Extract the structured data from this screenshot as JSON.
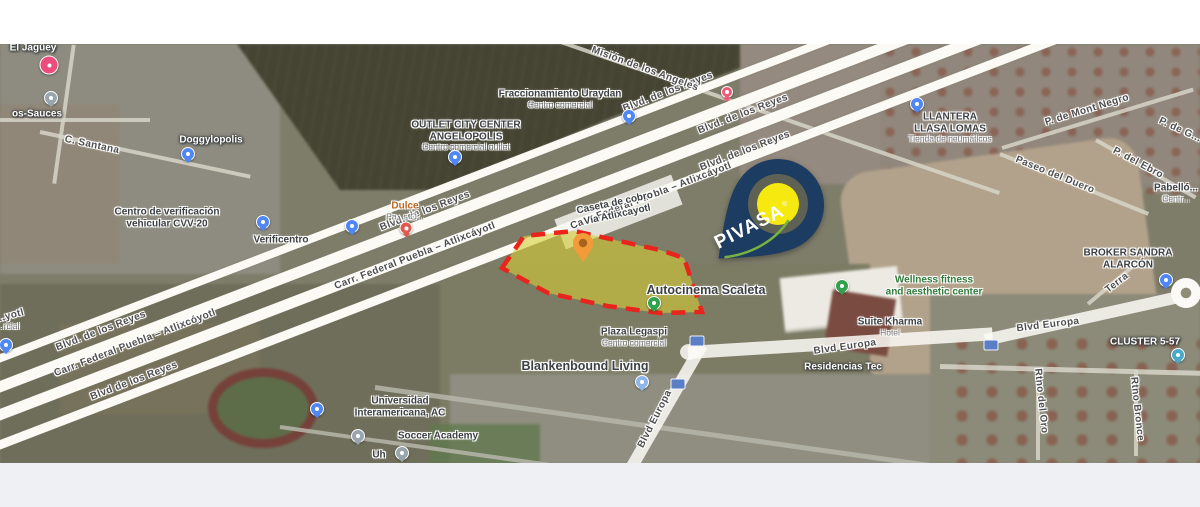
{
  "map_title": "Satellite map – Vía Atlixcáyotl / Blvd Europa, Puebla",
  "parcel": {
    "description": "highlighted lot for sale",
    "fill": "#d6cd34",
    "fill_opacity": 0.6,
    "outline_color": "#e8241d",
    "points": "42,68 64,36 114,31 200,50 224,58 242,112 200,113 147,106 88,93",
    "marker_color": "#f29b38",
    "marker_inner": "#a8641f"
  },
  "brand_pin": {
    "label": "PIVASA",
    "registered": "®",
    "body_color": "#1d3c61",
    "ring_color": "#6f6d52",
    "center_color": "#f6e90f",
    "swoosh_color": "#79b33f",
    "text_color": "#ffffff"
  },
  "road_labels": [
    {
      "t": "Blvd. de los Reyes",
      "x": 668,
      "y": 92,
      "rot": -21
    },
    {
      "t": "Blvd. de los Reyes",
      "x": 743,
      "y": 114,
      "rot": -21
    },
    {
      "t": "Blvd. de los Reyes",
      "x": 745,
      "y": 151,
      "rot": -21
    },
    {
      "t": "Blvd. de los Reyes",
      "x": 425,
      "y": 211,
      "rot": -21
    },
    {
      "t": "Blvd. de los Reyes",
      "x": 101,
      "y": 331,
      "rot": -21
    },
    {
      "t": "Blvd de los Reyes",
      "x": 134,
      "y": 381,
      "rot": -21
    },
    {
      "t": "Carr. Federal Puebla – Atlixcáyotl",
      "x": 651,
      "y": 196,
      "rot": -21
    },
    {
      "t": "Carr. Federal Puebla – Atlixcáyotl",
      "x": 415,
      "y": 256,
      "rot": -21
    },
    {
      "t": "Carr. Federal Puebla – Atlixcóyotl",
      "x": 135,
      "y": 343,
      "rot": -21
    },
    {
      "t": "Blvd Europa",
      "x": 845,
      "y": 347,
      "rot": -8
    },
    {
      "t": "Blvd Europa",
      "x": 1048,
      "y": 325,
      "rot": -7
    },
    {
      "t": "Blvd Europa",
      "x": 655,
      "y": 419,
      "rot": -63
    },
    {
      "t": "Misión de los Angeles",
      "x": 645,
      "y": 69,
      "rot": 20
    },
    {
      "t": "C. Santana",
      "x": 92,
      "y": 145,
      "rot": 12
    },
    {
      "t": "Paseo del Duero",
      "x": 1055,
      "y": 175,
      "rot": 22
    },
    {
      "t": "P. del Ebro",
      "x": 1138,
      "y": 163,
      "rot": 28
    },
    {
      "t": "P. de Mont Negro",
      "x": 1087,
      "y": 110,
      "rot": -17
    },
    {
      "t": "P. de G...",
      "x": 1180,
      "y": 130,
      "rot": 25
    },
    {
      "t": "Terra",
      "x": 1117,
      "y": 283,
      "rot": -38
    },
    {
      "t": "Rtno del Oro",
      "x": 1041,
      "y": 401,
      "rot": 84
    },
    {
      "t": "Rtno Bronce",
      "x": 1137,
      "y": 409,
      "rot": 84
    },
    {
      "t": "...yotl",
      "x": 10,
      "y": 316,
      "rot": -15
    }
  ],
  "place_labels": [
    {
      "x": 33,
      "y": 48,
      "cls": "white",
      "lines": [
        {
          "t": "El Jagüey"
        }
      ]
    },
    {
      "x": 37,
      "y": 114,
      "cls": "white",
      "lines": [
        {
          "t": "os-Sauces"
        }
      ]
    },
    {
      "x": 211,
      "y": 140,
      "cls": "white",
      "lines": [
        {
          "t": "Doggylopolis"
        }
      ]
    },
    {
      "x": 560,
      "y": 99,
      "cls": "bold",
      "lines": [
        {
          "t": "Fraccionamiento Uraydan"
        },
        {
          "t": "Centro comercial",
          "cls": "sub"
        }
      ]
    },
    {
      "x": 466,
      "y": 136,
      "cls": "bold",
      "lines": [
        {
          "t": "OUTLET CITY CENTER"
        },
        {
          "t": "ANGELOPOLIS"
        },
        {
          "t": "Centro comercial outlet",
          "cls": "sub"
        }
      ]
    },
    {
      "x": 167,
      "y": 218,
      "cls": "bold",
      "lines": [
        {
          "t": "Centro de verificación"
        },
        {
          "t": "vehicular CVV-20"
        }
      ]
    },
    {
      "x": 281,
      "y": 240,
      "cls": "bold",
      "lines": [
        {
          "t": "Verificentro"
        }
      ]
    },
    {
      "x": 405,
      "y": 211,
      "cls": "orange",
      "lines": [
        {
          "t": "Dulce"
        },
        {
          "t": "Pa...s O...",
          "cls": "sub"
        }
      ]
    },
    {
      "x": 616,
      "y": 209,
      "rot": -12,
      "cls": "bold",
      "lines": [
        {
          "t": "Caseta de cobro"
        },
        {
          "t": "Vía Atlixcayotl"
        }
      ]
    },
    {
      "x": 950,
      "y": 128,
      "cls": "bold",
      "lines": [
        {
          "t": "LLANTERA"
        },
        {
          "t": "LLASA LOMAS"
        },
        {
          "t": "Tienda de neumáticos",
          "cls": "sub"
        }
      ]
    },
    {
      "x": 706,
      "y": 290,
      "cls": "big",
      "lines": [
        {
          "t": "Autocinema Scaleta"
        }
      ]
    },
    {
      "x": 934,
      "y": 286,
      "cls": "green",
      "lines": [
        {
          "t": "Wellness fitness"
        },
        {
          "t": "and aesthetic center"
        }
      ]
    },
    {
      "x": 890,
      "y": 327,
      "cls": "bold",
      "lines": [
        {
          "t": "Suite Kharma"
        },
        {
          "t": "Hotel",
          "cls": "sub"
        }
      ]
    },
    {
      "x": 634,
      "y": 337,
      "cls": "bold",
      "lines": [
        {
          "t": "Plaza Legaspi"
        },
        {
          "t": "Centro comercial",
          "cls": "sub"
        }
      ]
    },
    {
      "x": 585,
      "y": 366,
      "cls": "big",
      "lines": [
        {
          "t": "Blankenbound Living"
        }
      ]
    },
    {
      "x": 843,
      "y": 367,
      "cls": "white",
      "lines": [
        {
          "t": "Residencias Tec"
        }
      ]
    },
    {
      "x": 400,
      "y": 407,
      "cls": "bold",
      "lines": [
        {
          "t": "Universidad"
        },
        {
          "t": "Interamericana, AC"
        }
      ]
    },
    {
      "x": 438,
      "y": 436,
      "cls": "bold",
      "lines": [
        {
          "t": "Soccer Academy"
        }
      ]
    },
    {
      "x": 1145,
      "y": 342,
      "cls": "white",
      "lines": [
        {
          "t": "CLUSTER 5-57"
        }
      ]
    },
    {
      "x": 1128,
      "y": 259,
      "cls": "bold",
      "lines": [
        {
          "t": "BROKER SANDRA"
        },
        {
          "t": "ALARCÓN"
        }
      ]
    },
    {
      "x": 1176,
      "y": 193,
      "cls": "bold",
      "lines": [
        {
          "t": "Pabelló..."
        },
        {
          "t": "Centr...",
          "cls": "sub"
        }
      ]
    },
    {
      "x": 379,
      "y": 455,
      "cls": "bold",
      "lines": [
        {
          "t": "Uh"
        }
      ]
    },
    {
      "x": 8,
      "y": 327,
      "cls": "bold",
      "lines": [
        {
          "t": "...rcial",
          "cls": "sub"
        }
      ]
    }
  ],
  "pins": [
    {
      "kind": "pinkbig",
      "x": 49,
      "y": 65,
      "name": "heart-pin-el-jaguey"
    },
    {
      "kind": "gray",
      "x": 51,
      "y": 98,
      "name": "gray-pin-los-sauces"
    },
    {
      "kind": "blue",
      "x": 188,
      "y": 154,
      "name": "blue-pin-doggylopolis"
    },
    {
      "kind": "blue",
      "x": 263,
      "y": 222,
      "name": "blue-pin-verificacion"
    },
    {
      "kind": "blue",
      "x": 352,
      "y": 226,
      "name": "blue-pin-verificentro"
    },
    {
      "kind": "food",
      "x": 406,
      "y": 228,
      "name": "red-pin-dulce"
    },
    {
      "kind": "blue",
      "x": 455,
      "y": 157,
      "name": "blue-pin-outlet"
    },
    {
      "kind": "blue",
      "x": 629,
      "y": 116,
      "name": "blue-pin-uraydan"
    },
    {
      "kind": "pinksmall",
      "x": 727,
      "y": 92,
      "name": "pink-pin-reyes"
    },
    {
      "kind": "blue",
      "x": 917,
      "y": 104,
      "name": "blue-pin-llantera"
    },
    {
      "kind": "green",
      "x": 654,
      "y": 303,
      "name": "green-pin-autocinema"
    },
    {
      "kind": "green",
      "x": 842,
      "y": 286,
      "name": "green-pin-wellness"
    },
    {
      "kind": "lightblue",
      "x": 642,
      "y": 382,
      "name": "lightblue-pin-blankenbound"
    },
    {
      "kind": "blue",
      "x": 317,
      "y": 409,
      "name": "blue-pin-universidad"
    },
    {
      "kind": "gray",
      "x": 358,
      "y": 436,
      "name": "gray-pin-soccer-academy"
    },
    {
      "kind": "gray",
      "x": 402,
      "y": 453,
      "name": "gray-pin-uh"
    },
    {
      "kind": "blue",
      "x": 6,
      "y": 345,
      "name": "blue-pin-left-edge"
    },
    {
      "kind": "blue",
      "x": 1166,
      "y": 280,
      "name": "blue-pin-roundabout"
    },
    {
      "kind": "teal",
      "x": 1178,
      "y": 355,
      "name": "blue-pin-cluster"
    }
  ],
  "shields": [
    {
      "x": 697,
      "y": 341
    },
    {
      "x": 678,
      "y": 384
    },
    {
      "x": 991,
      "y": 345
    }
  ]
}
